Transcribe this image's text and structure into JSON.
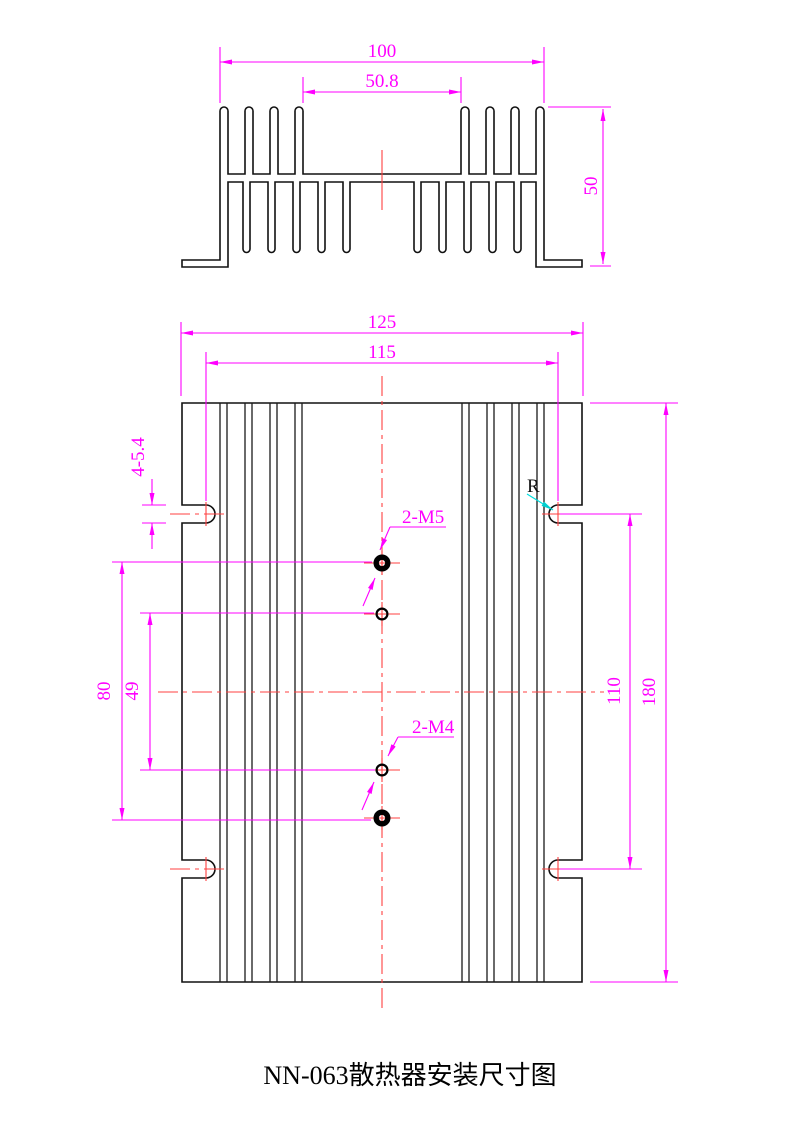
{
  "title": "NN-063散热器安装尺寸图",
  "colors": {
    "dimension": "#ff00ff",
    "centerline": "#ff4040",
    "outline": "#111111",
    "radius_leader": "#00dede",
    "background": "#ffffff"
  },
  "section_view": {
    "description": "heatsink extrusion cross-section profile",
    "dims": {
      "fin_span_width": "100",
      "module_width": "50.8",
      "height": "50"
    }
  },
  "plan_view": {
    "description": "heatsink base plate mounting layout",
    "dims": {
      "overall_width": "125",
      "slot_center_width": "115",
      "slot_size": "4-5.4",
      "hole_pitch_outer": "80",
      "hole_pitch_inner": "49",
      "slot_center_height": "110",
      "overall_height": "180"
    },
    "callouts": {
      "m5_holes": "2-M5",
      "m4_holes": "2-M4",
      "radius_label": "R"
    }
  }
}
